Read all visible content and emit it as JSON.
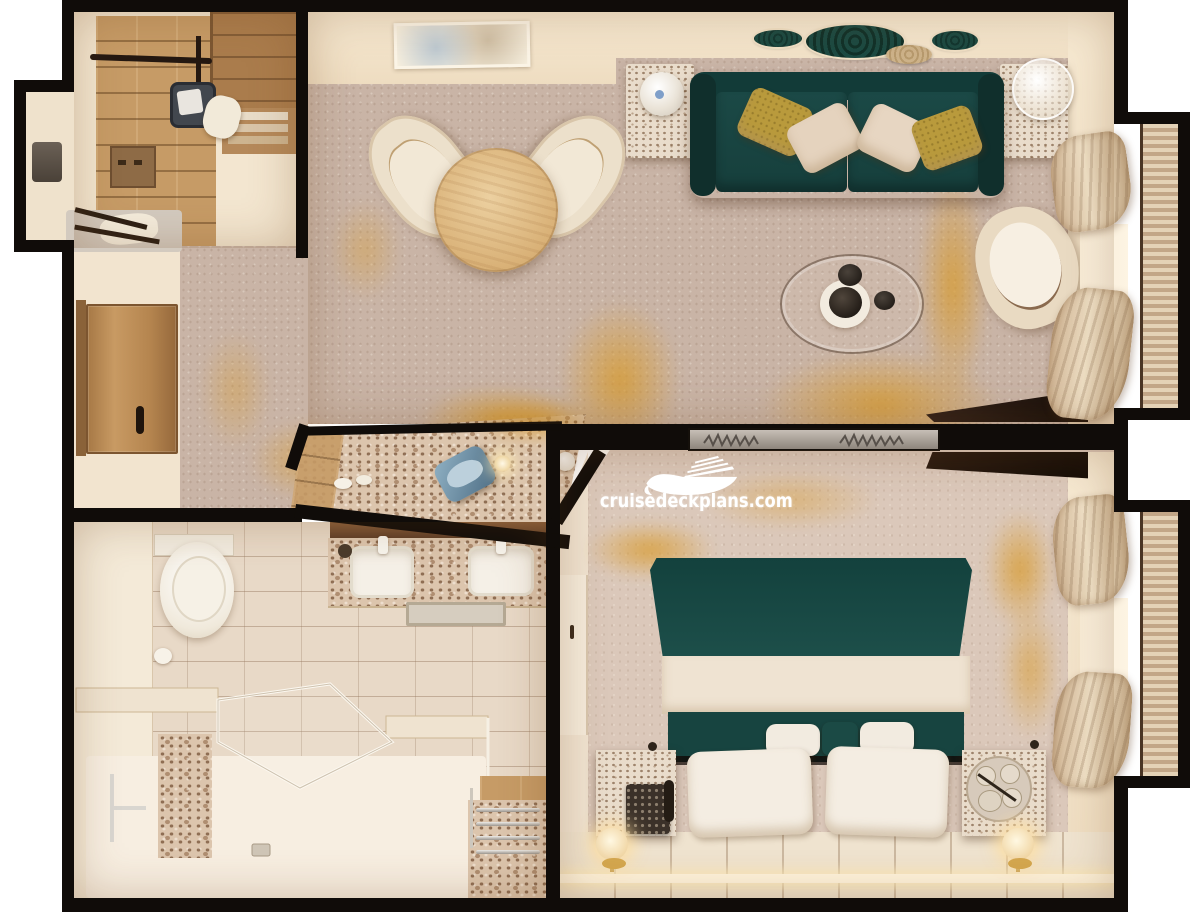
{
  "watermark": {
    "text": "cruisedeckplans.com",
    "logo_icon": "cruise-ship-icon",
    "color": "#ffffff"
  },
  "palette": {
    "wall_outline": "#100c09",
    "carpet": "#c9b4a6",
    "teal_fabric": "#1b4a46",
    "gold_accent": "#d89b2f",
    "cream_wall": "#f3e6d0",
    "wood": "#c0955f",
    "marble": "#e9dccb",
    "tile": "#e8d9c7",
    "gold_pillow": "#b99a3c",
    "chrome": "#d9d6d0"
  },
  "floorplan": {
    "type": "cruise-suite-top-down-render",
    "rooms": [
      {
        "id": "walk-in-closet",
        "items": [
          "wood-floor",
          "hanging-rail",
          "safe",
          "shelving-unit",
          "drawer-box",
          "luggage-rack",
          "garment"
        ]
      },
      {
        "id": "entry-corridor",
        "items": [
          "entry-door",
          "door-handle",
          "carpet"
        ]
      },
      {
        "id": "living-room",
        "items": [
          "wall-art",
          "oval-wall-decor",
          "sofa",
          "throw-pillows",
          "side-table-lamp-left",
          "side-table-lamp-right",
          "dining-table",
          "dining-chairs",
          "coffee-table",
          "armchair",
          "console-desk",
          "balcony-curtains"
        ]
      },
      {
        "id": "vanity-dressing-area",
        "items": [
          "marble-counter",
          "blue-chair",
          "table-lamp",
          "cups"
        ]
      },
      {
        "id": "bathroom",
        "items": [
          "double-sink-vanity",
          "mirror",
          "bath-mat",
          "toilet",
          "toilet-paper-holder",
          "glass-shower",
          "shower-bench",
          "marble-pillar",
          "grab-bar",
          "floor-drains",
          "towel-rack-bench"
        ]
      },
      {
        "id": "bedroom",
        "items": [
          "double-bed",
          "teal-blanket",
          "pillows",
          "bolster-pillows",
          "nightstand-left",
          "telephone",
          "nightstand-right",
          "coffee-tray",
          "gold-lamp-left",
          "gold-lamp-right",
          "wardrobe",
          "etched-glass-partition",
          "balcony-curtains",
          "slatted-platform"
        ]
      }
    ]
  }
}
